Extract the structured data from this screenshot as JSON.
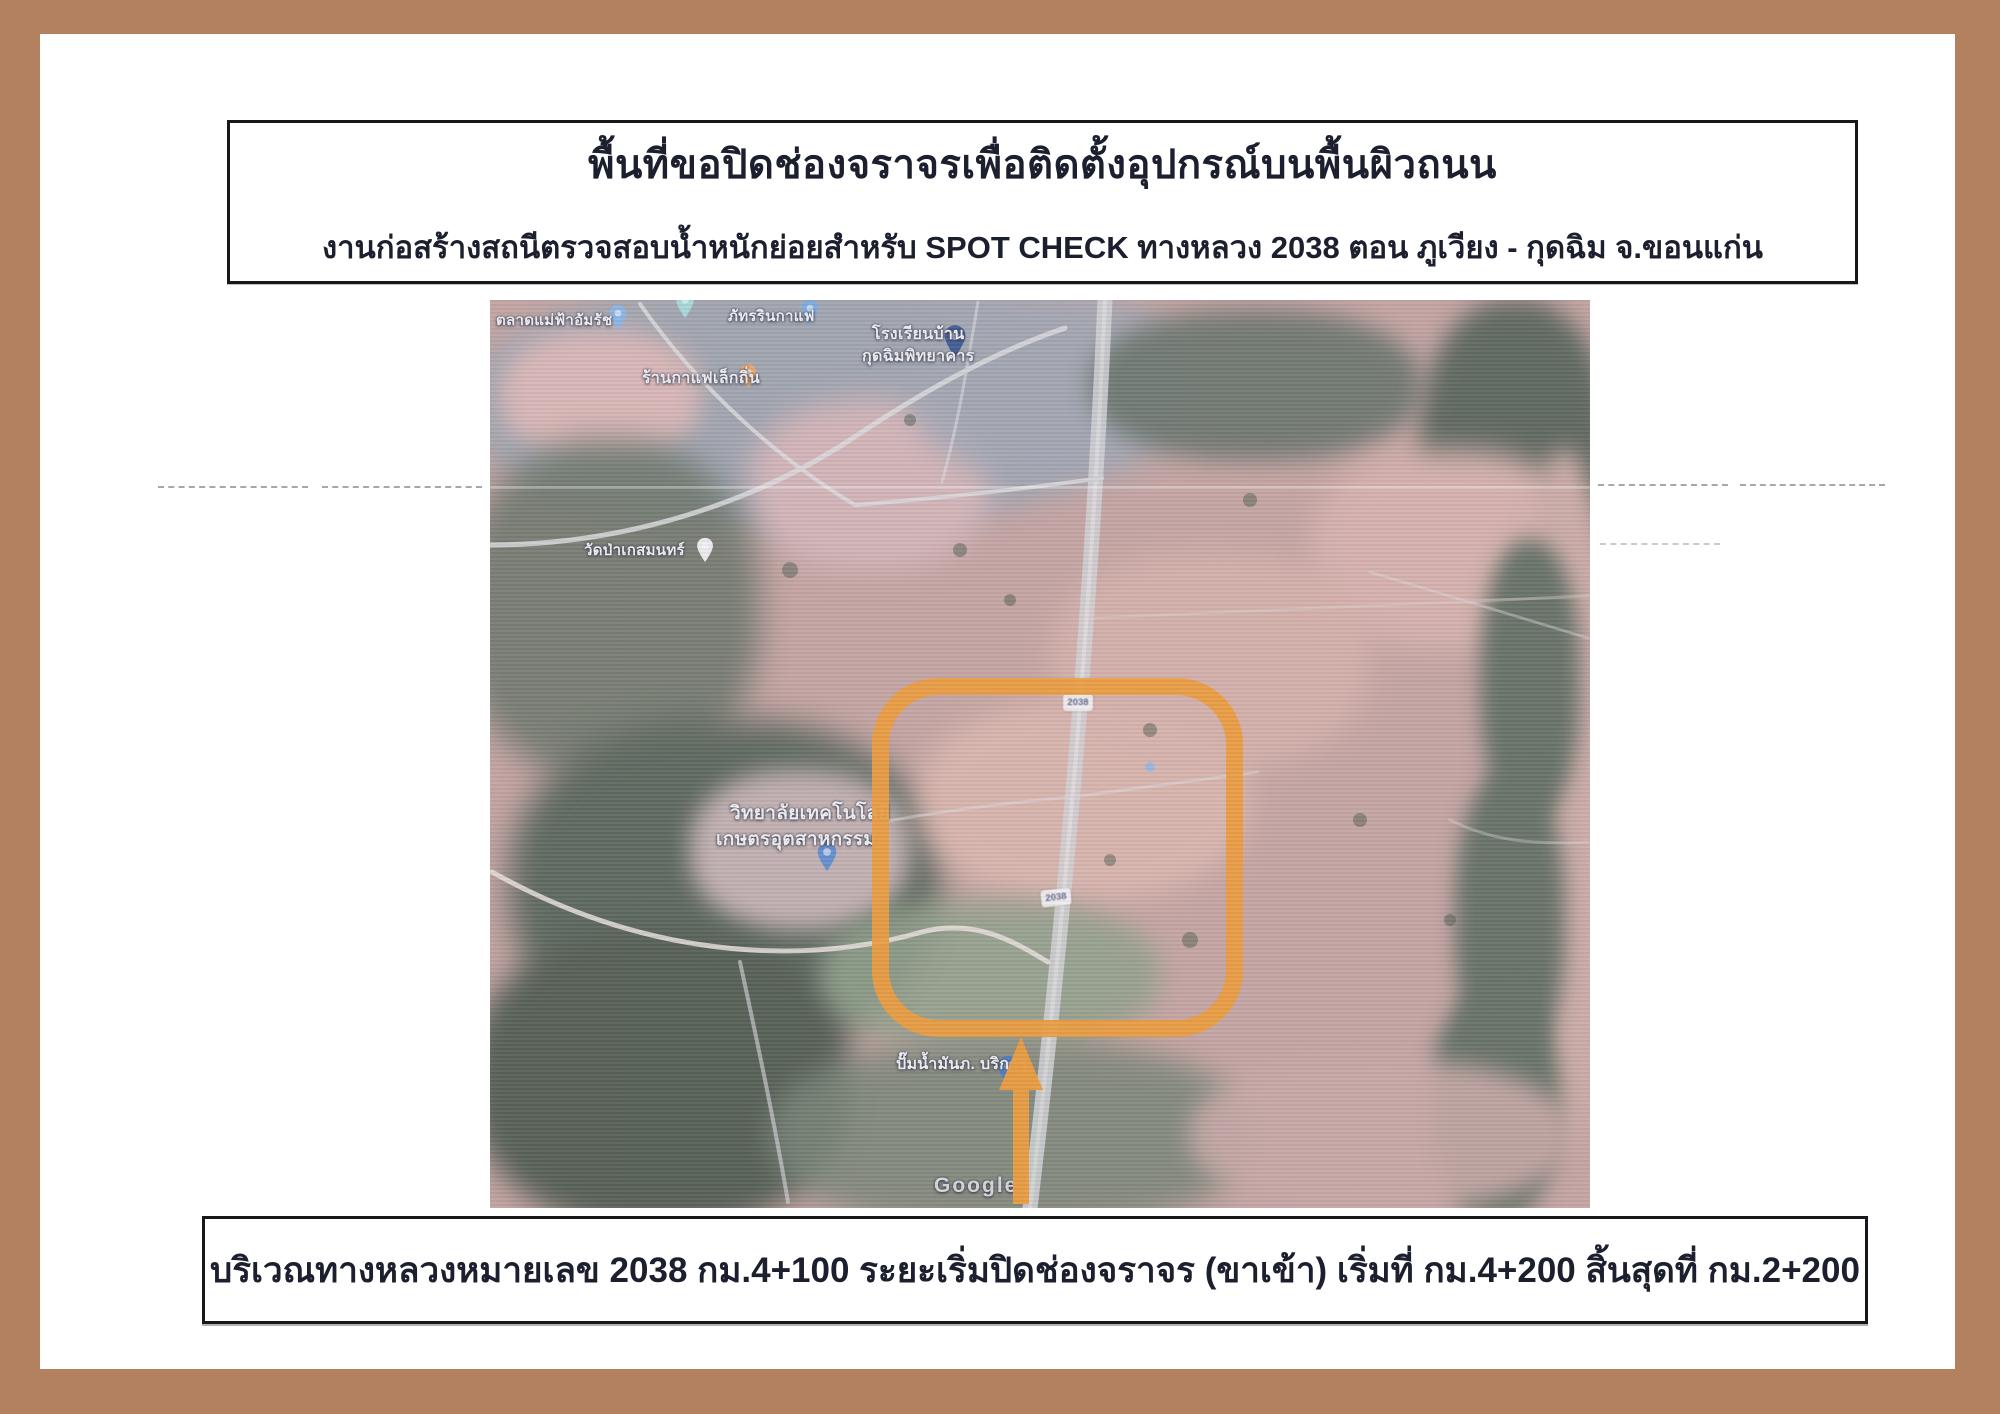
{
  "colors": {
    "frame": "#b3815f",
    "page": "#ffffff",
    "ink": "#1c1f2e",
    "highlight_orange": "#ea9c40"
  },
  "header": {
    "title": "พื้นที่ขอปิดช่องจราจรเพื่อติดตั้งอุปกรณ์บนพื้นผิวถนน",
    "subtitle": "งานก่อสร้างสถนีตรวจสอบน้ำหนักย่อยสำหรับ SPOT CHECK  ทางหลวง 2038 ตอน ภูเวียง - กุดฉิม จ.ขอนแก่น"
  },
  "map": {
    "type": "scanned satellite map with orange highlight rectangle and arrow",
    "route_shield": "2038",
    "labels": {
      "market": "ตลาดแม่ฟ้าอัมรัช",
      "cafe": "ภัทรรินกาแฟ",
      "school1": "โรงเรียนบ้าน",
      "school2": "กุดฉิมพิทยาคาร",
      "coffee": "ร้านกาแฟเล็กถิ่น",
      "temple": "วัดป่าเกสมนทร์",
      "college1": "วิทยาลัยเทคโนโลยี",
      "college2": "เกษตรอุตสาหกรรม",
      "gas": "ปั๊มน้ำมันภ. บริการ",
      "watermark": "Google"
    }
  },
  "footer": {
    "caption": "บริเวณทางหลวงหมายเลข 2038 กม.4+100 ระยะเริ่มปิดช่องจราจร (ขาเข้า) เริ่มที่ กม.4+200 สิ้นสุดที่ กม.2+200"
  }
}
